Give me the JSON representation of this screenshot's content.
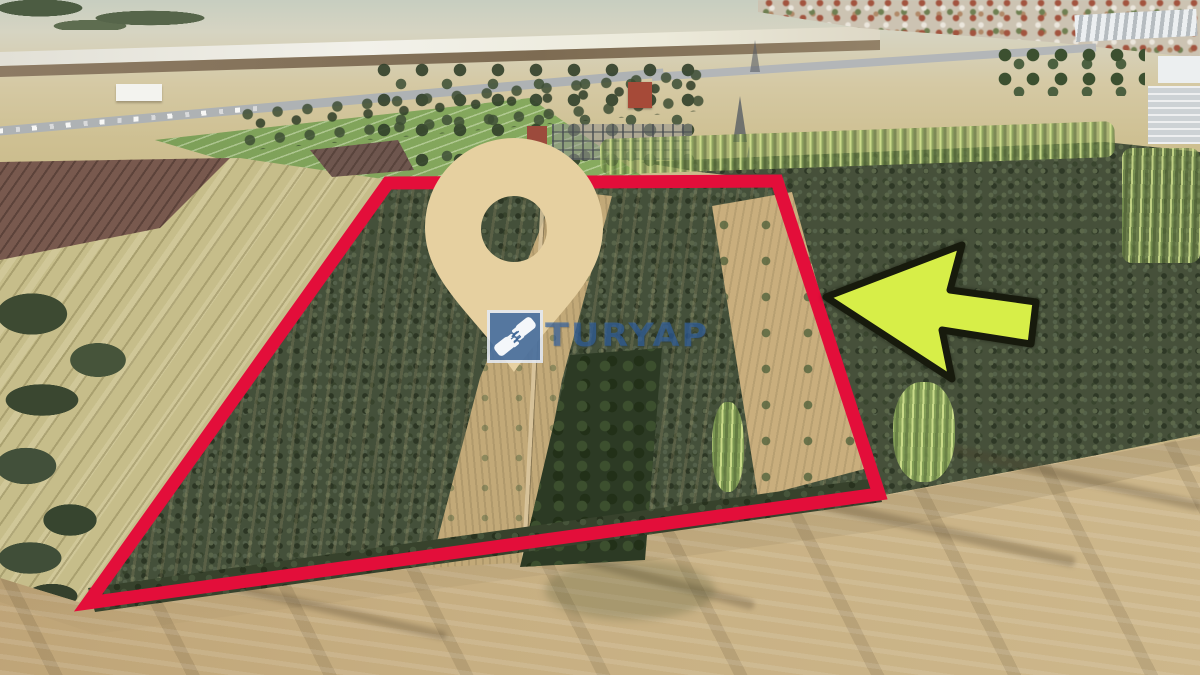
{
  "brand": {
    "name": "TURYAP",
    "logo_icon": "handshake-icon",
    "logo_square_color": "#36608f",
    "wordmark_color": "rgba(47,98,170,0.60)"
  },
  "annotations": {
    "parcel_outline": {
      "color": "#e30e3a",
      "stroke_width": 13,
      "points": "388,183 777,181 879,494 88,603"
    },
    "location_pin": {
      "color": "#e6d0a0",
      "path": "M514,372 C470,310 425,281 425,227 A89,89 0 1 1 603,227 C603,281 558,310 514,372 Z M514,196 a33,33 0 1 0 0,66 a33,33 0 1 0 0,-66 Z"
    },
    "direction_arrow": {
      "fill": "#d7ee48",
      "outline": "#171a0d",
      "points": "826,297 962,245 950,290 1036,302 1031,344 942,330 952,379"
    }
  },
  "scene": {
    "description": "Aerial drone photo of farmland: an orchard parcel outlined in red, olive groves, striped stubble fields, an airstrip, road with cars and a town in the distance, harvested tan field in the foreground",
    "palette": {
      "foreground_field": "#c4ac7e",
      "striped_field": "#c6bd8a",
      "orchard_dark": "#46503a",
      "crops_green": "#83a95c",
      "runway": "#efeee6",
      "road": "#aeb2b4",
      "poplar_green": "#9cb26b"
    }
  }
}
